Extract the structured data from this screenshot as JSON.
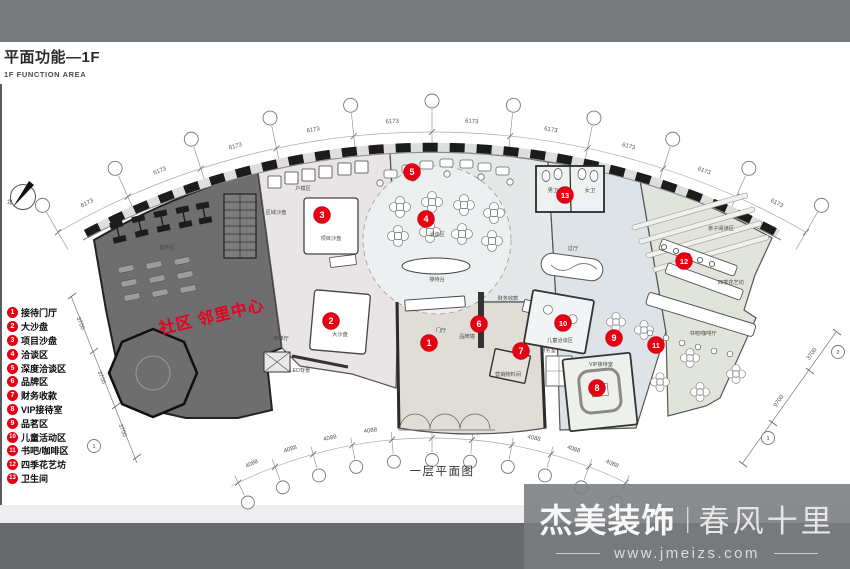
{
  "header": {
    "title": "平面功能—1F",
    "subtitle": "1F FUNCTION AREA"
  },
  "legend": {
    "items": [
      {
        "num": "1",
        "label": "接待门厅"
      },
      {
        "num": "2",
        "label": "大沙盘"
      },
      {
        "num": "3",
        "label": "项目沙盘"
      },
      {
        "num": "4",
        "label": "洽谈区"
      },
      {
        "num": "5",
        "label": "深度洽谈区"
      },
      {
        "num": "6",
        "label": "品牌区"
      },
      {
        "num": "7",
        "label": "财务收款"
      },
      {
        "num": "8",
        "label": "VIP接待室"
      },
      {
        "num": "9",
        "label": "品茗区"
      },
      {
        "num": "10",
        "label": "儿童活动区"
      },
      {
        "num": "11",
        "label": "书吧/咖啡区"
      },
      {
        "num": "12",
        "label": "四季花艺坊"
      },
      {
        "num": "13",
        "label": "卫生间"
      }
    ]
  },
  "plan": {
    "caption": "一层平面图",
    "watermark": "社区 邻里中心",
    "compass_label": "北",
    "dim_top_label": "6173",
    "dim_bottom_label": "4088",
    "dim_left_labels": [
      "3700",
      "3700",
      "3700"
    ],
    "dim_right_labels": [
      "3700",
      "9700"
    ],
    "diag_bubble_labels": [
      "1",
      "1",
      "2"
    ],
    "markers": [
      {
        "num": "1",
        "x": 429,
        "y": 343
      },
      {
        "num": "2",
        "x": 331,
        "y": 321
      },
      {
        "num": "3",
        "x": 322,
        "y": 215
      },
      {
        "num": "4",
        "x": 426,
        "y": 219
      },
      {
        "num": "5",
        "x": 412,
        "y": 172
      },
      {
        "num": "6",
        "x": 479,
        "y": 324
      },
      {
        "num": "7",
        "x": 521,
        "y": 351
      },
      {
        "num": "8",
        "x": 597,
        "y": 388
      },
      {
        "num": "9",
        "x": 614,
        "y": 338
      },
      {
        "num": "10",
        "x": 563,
        "y": 323
      },
      {
        "num": "11",
        "x": 656,
        "y": 345
      },
      {
        "num": "12",
        "x": 684,
        "y": 261
      },
      {
        "num": "13",
        "x": 565,
        "y": 195
      }
    ],
    "room_labels": [
      {
        "text": "健身区",
        "x": 167,
        "y": 249
      },
      {
        "text": "电梯厅",
        "x": 281,
        "y": 340
      },
      {
        "text": "户模区",
        "x": 303,
        "y": 190
      },
      {
        "text": "区域沙盘",
        "x": 276,
        "y": 214
      },
      {
        "text": "项目沙盘",
        "x": 331,
        "y": 240
      },
      {
        "text": "大沙盘",
        "x": 340,
        "y": 336
      },
      {
        "text": "LED背景",
        "x": 300,
        "y": 372
      },
      {
        "text": "接待台",
        "x": 437,
        "y": 281
      },
      {
        "text": "洽谈区",
        "x": 437,
        "y": 236
      },
      {
        "text": "门厅",
        "x": 441,
        "y": 332
      },
      {
        "text": "品牌墙",
        "x": 467,
        "y": 338
      },
      {
        "text": "财务收款",
        "x": 508,
        "y": 300
      },
      {
        "text": "财务室",
        "x": 548,
        "y": 352
      },
      {
        "text": "营销物料间",
        "x": 508,
        "y": 376
      },
      {
        "text": "男卫",
        "x": 553,
        "y": 192
      },
      {
        "text": "女卫",
        "x": 590,
        "y": 192
      },
      {
        "text": "过厅",
        "x": 573,
        "y": 250
      },
      {
        "text": "儿童洽谈区",
        "x": 560,
        "y": 342
      },
      {
        "text": "VIP接待室",
        "x": 601,
        "y": 366
      },
      {
        "text": "亲子阅读区",
        "x": 721,
        "y": 230
      },
      {
        "text": "四季花艺坊",
        "x": 731,
        "y": 284
      },
      {
        "text": "书吧/咖啡厅",
        "x": 703,
        "y": 335
      }
    ]
  },
  "footer": {
    "brand": "杰美装饰",
    "divider": "|",
    "slogan": "春风十里",
    "url": "www.jmeizs.com"
  },
  "colors": {
    "accent_red": "#e60012",
    "band_top": "#797a7c",
    "band_bottom": "#67696c",
    "zone_dark": "#6e6e6e",
    "zone_pink": "#e9e4e5",
    "zone_center": "#e4e8e8",
    "zone_entry": "#dfddd5",
    "zone_blue": "#dde3e6",
    "zone_green": "#e1e4da"
  }
}
